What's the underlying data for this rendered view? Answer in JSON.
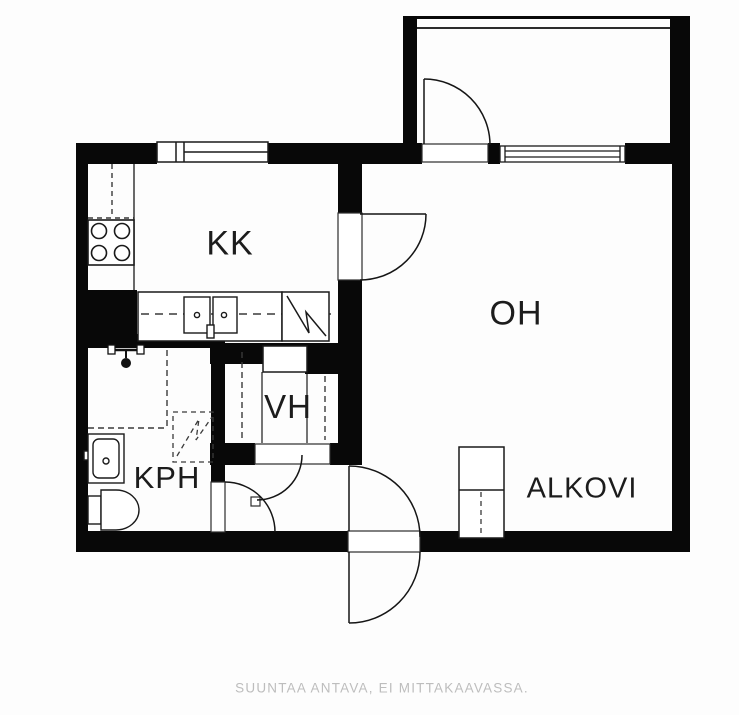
{
  "plan": {
    "type": "apartment-floor-plan",
    "orientation_note": "studio apartment with balcony"
  },
  "rooms": {
    "kk": {
      "label": "KK"
    },
    "oh": {
      "label": "OH"
    },
    "vh": {
      "label": "VH"
    },
    "kph": {
      "label": "KPH"
    },
    "alkovi": {
      "label": "ALKOVI"
    }
  },
  "caption": {
    "text": "SUUNTAA ANTAVA, EI MITTAKAAVASSA."
  },
  "colors": {
    "wall": "#080808",
    "line": "#1a1a1a",
    "dashed_line": "#3a3a3a",
    "caption_text": "#bdbdbd",
    "background": "#ffffff"
  },
  "symbols": {
    "stove": "stove-icon",
    "fridge_reservation": "fridge-dashed-outline",
    "kitchen_sink": "double-sink-icon",
    "appliance_reservation": "zigzag-reservation-icon",
    "shower_mixer": "shower-mixer-icon",
    "washbasin": "washbasin-icon",
    "toilet": "toilet-icon",
    "wardrobe": "wardrobe-icon",
    "doors": "door-swing-arc",
    "windows": "window-symbol"
  }
}
